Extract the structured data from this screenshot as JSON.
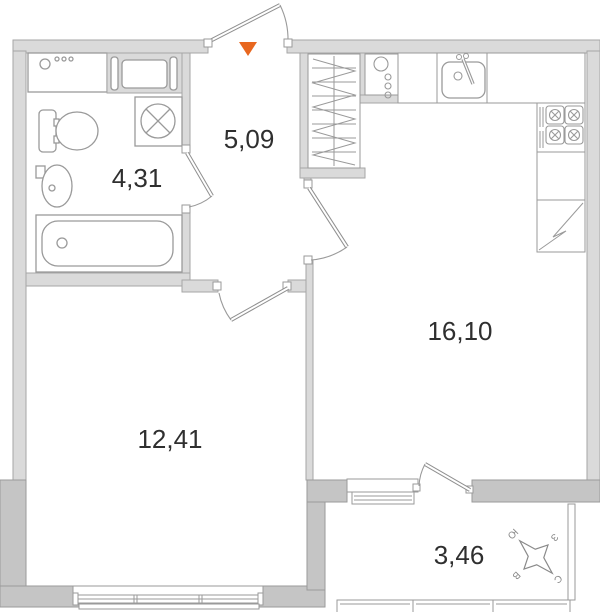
{
  "plan": {
    "title": "apartment-floor-plan",
    "rooms": [
      {
        "id": "bathroom",
        "area": "4,31"
      },
      {
        "id": "hallway",
        "area": "5,09"
      },
      {
        "id": "kitchen-living",
        "area": "16,10"
      },
      {
        "id": "bedroom",
        "area": "12,41"
      },
      {
        "id": "balcony",
        "area": "3,46"
      }
    ],
    "compass": {
      "north": "С",
      "south": "Ю",
      "west": "З",
      "east": "В"
    },
    "colors": {
      "wall_light": "#dadada",
      "wall_dark": "#c5c5c5",
      "outline": "#9a9a9a",
      "entrance_marker": "#e8671f",
      "label_text": "#2f2f2f"
    },
    "icons": [
      "entrance-marker-icon",
      "washing-machine-icon",
      "towel-dryer-icon",
      "toilet-icon",
      "washbasin-icon",
      "bathtub-icon",
      "wardrobe-icon",
      "water-heater-icon",
      "kitchen-sink-icon",
      "stove-icon",
      "corner-counter-icon",
      "window-icon",
      "door-icon",
      "compass-rose-icon"
    ]
  }
}
